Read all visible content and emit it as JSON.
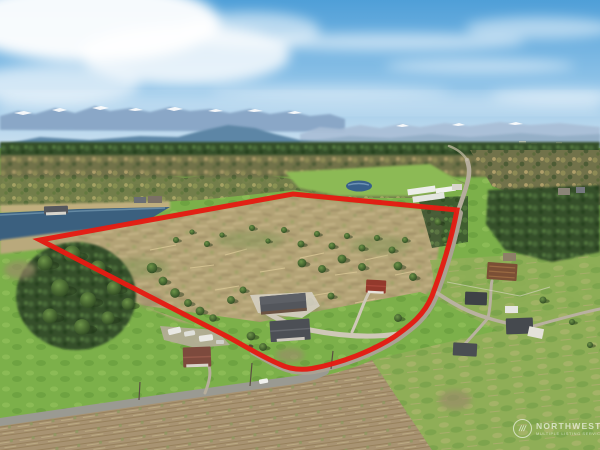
{
  "photo": {
    "kind": "aerial-drone-real-estate-photo",
    "description": "Aerial view of rural wooded acreage with homes, outlined by a red property boundary, mountains on the horizon"
  },
  "overlay": {
    "boundary_color": "#e41c13",
    "boundary_shape": "property-outline-polygon"
  },
  "watermark": {
    "logo": "nwmls-circle-slashes-logo",
    "name": "NORTHWEST",
    "tagline": "MULTIPLE LISTING SERVICE",
    "text_color": "#ffffff"
  },
  "scene": {
    "sky_color": "#56a3da",
    "cloud_color": "#ffffff",
    "mountain_color": "#8aa7c7",
    "snow_color": "#ffffff",
    "foothill_color": "#5d86a6",
    "pond_color": "#3b607f",
    "field_green": "#7cb04a",
    "cleared_land_tan": "#b3a376",
    "scrub_brown": "#a89372",
    "road_gray": "#9a9a92",
    "features": [
      "snow-capped mountain range on horizon",
      "blue sky with wispy clouds",
      "pond with waterfront homes",
      "partially cleared timber parcel outlined in red",
      "house, shop and red-roofed shed inside boundary",
      "country road along east edge",
      "neighboring barns and farmhouses",
      "brown scrub field in foreground"
    ]
  }
}
